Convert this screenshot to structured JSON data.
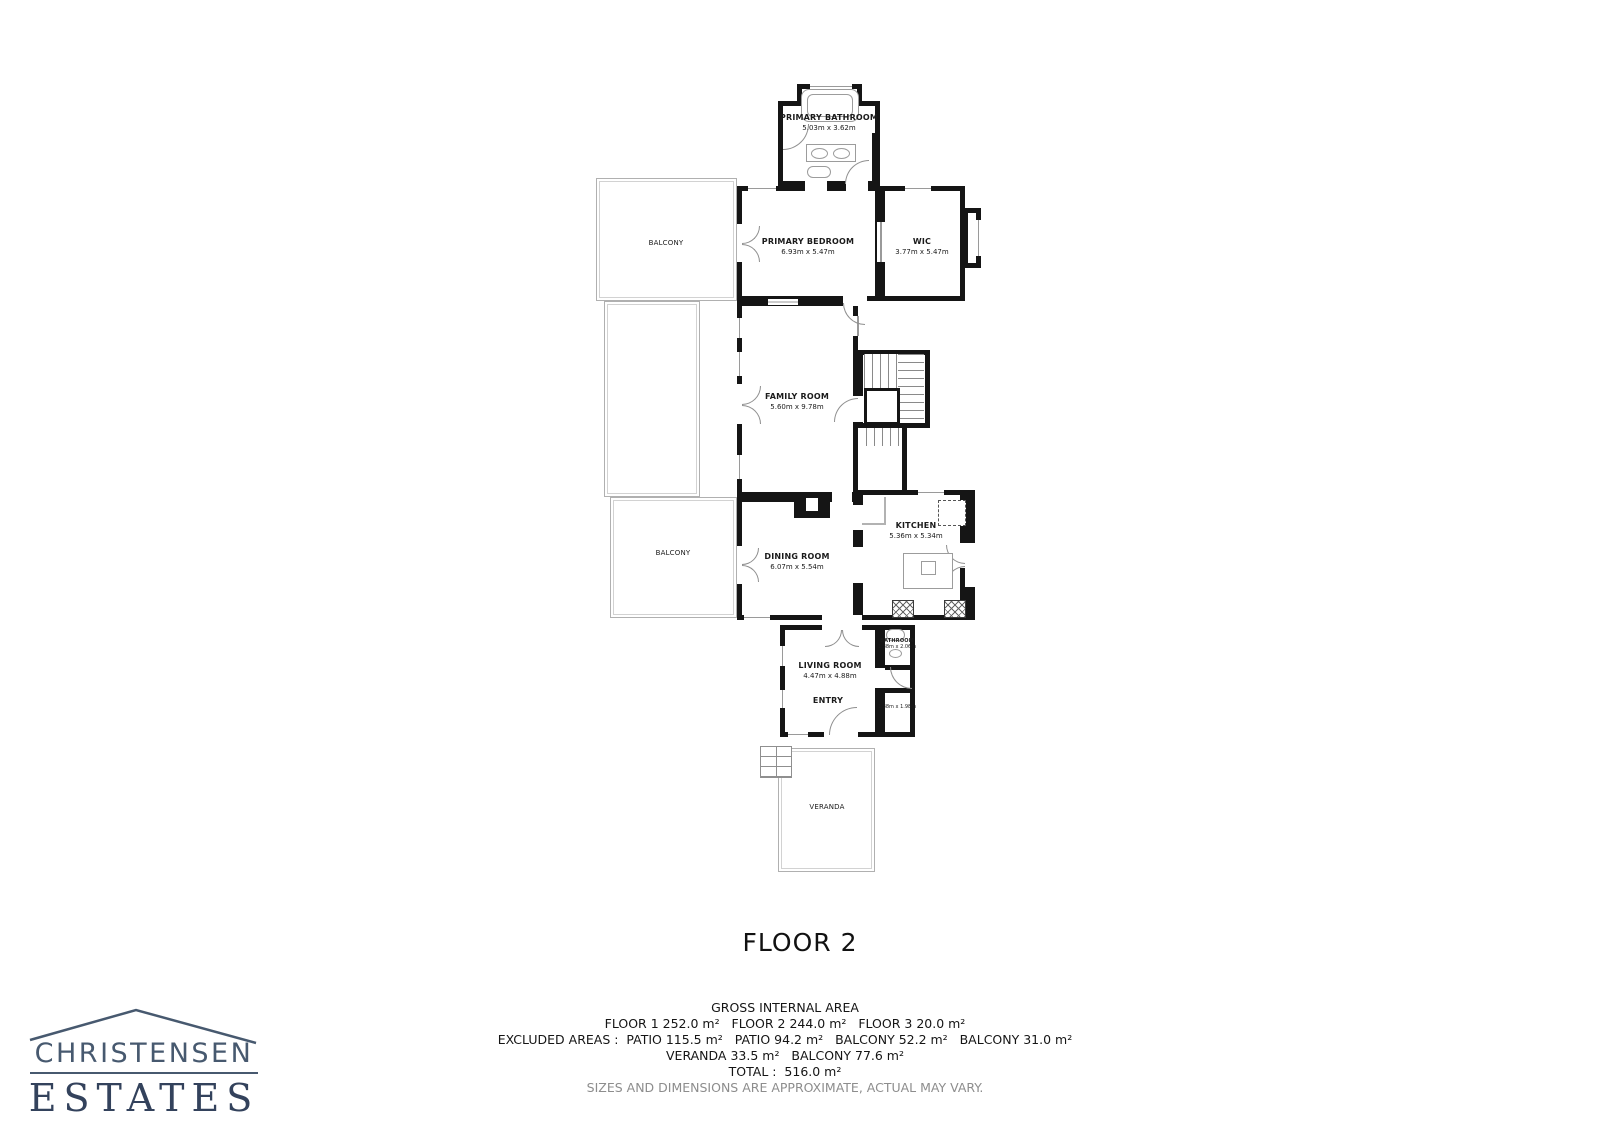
{
  "floor_title": "FLOOR 2",
  "rooms": {
    "primary_bathroom": {
      "name": "PRIMARY BATHROOM",
      "dims": "5.03m x 3.62m"
    },
    "primary_bedroom": {
      "name": "PRIMARY BEDROOM",
      "dims": "6.93m x 5.47m"
    },
    "wic": {
      "name": "WIC",
      "dims": "3.77m x 5.47m"
    },
    "balcony_upper": {
      "name": "BALCONY"
    },
    "family_room": {
      "name": "FAMILY ROOM",
      "dims": "5.60m x 9.78m"
    },
    "kitchen": {
      "name": "KITCHEN",
      "dims": "5.36m x 5.34m"
    },
    "dining_room": {
      "name": "DINING ROOM",
      "dims": "6.07m x 5.54m"
    },
    "balcony_lower": {
      "name": "BALCONY"
    },
    "living_room": {
      "name": "LIVING ROOM",
      "dims": "4.47m x 4.88m"
    },
    "bathroom_small": {
      "name": "BATHROOM",
      "dims": "1.38m x 2.06m"
    },
    "entry": {
      "name": "ENTRY"
    },
    "closet": {
      "dims": "1.38m x 1.98m"
    },
    "veranda": {
      "name": "VERANDA"
    }
  },
  "footer": {
    "gross_title": "GROSS INTERNAL AREA",
    "line_floors": "FLOOR 1 252.0 m²   FLOOR 2 244.0 m²   FLOOR 3 20.0 m²",
    "line_excluded": "EXCLUDED AREAS :  PATIO 115.5 m²   PATIO 94.2 m²   BALCONY 52.2 m²   BALCONY 31.0 m²",
    "line_excluded2": "VERANDA 33.5 m²   BALCONY 77.6 m²",
    "line_total": "TOTAL :  516.0 m²",
    "disclaimer": "SIZES AND DIMENSIONS ARE APPROXIMATE, ACTUAL MAY VARY."
  },
  "logo": {
    "line1": "CHRISTENSEN",
    "line2": "ESTATES"
  },
  "colors": {
    "wall": "#151515",
    "thin_outline": "#b0b0b0",
    "logo_top": "#47596f",
    "logo_bottom": "#33425c",
    "disclaimer_text": "#8d8d8d"
  }
}
